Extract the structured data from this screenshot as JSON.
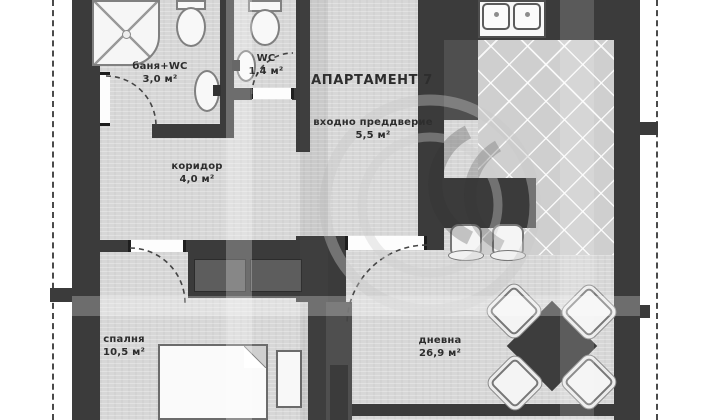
{
  "plan": {
    "title": "АПАРТАМЕНТ 7",
    "rooms": [
      {
        "name": "баня+WC",
        "area": "3,0 м²"
      },
      {
        "name": "WC",
        "area": "1,4 м²"
      },
      {
        "name": "входно преддверие",
        "area": "5,5 м²"
      },
      {
        "name": "коридор",
        "area": "4,0 м²"
      },
      {
        "name": "спалня",
        "area": "10,5 м²"
      },
      {
        "name": "дневна",
        "area": "26,9 м²"
      }
    ],
    "colors": {
      "wall": "#3b3b3b",
      "floor": "#d7d7d7",
      "fixture": "#f8f8f8",
      "background": "#ffffff"
    }
  }
}
